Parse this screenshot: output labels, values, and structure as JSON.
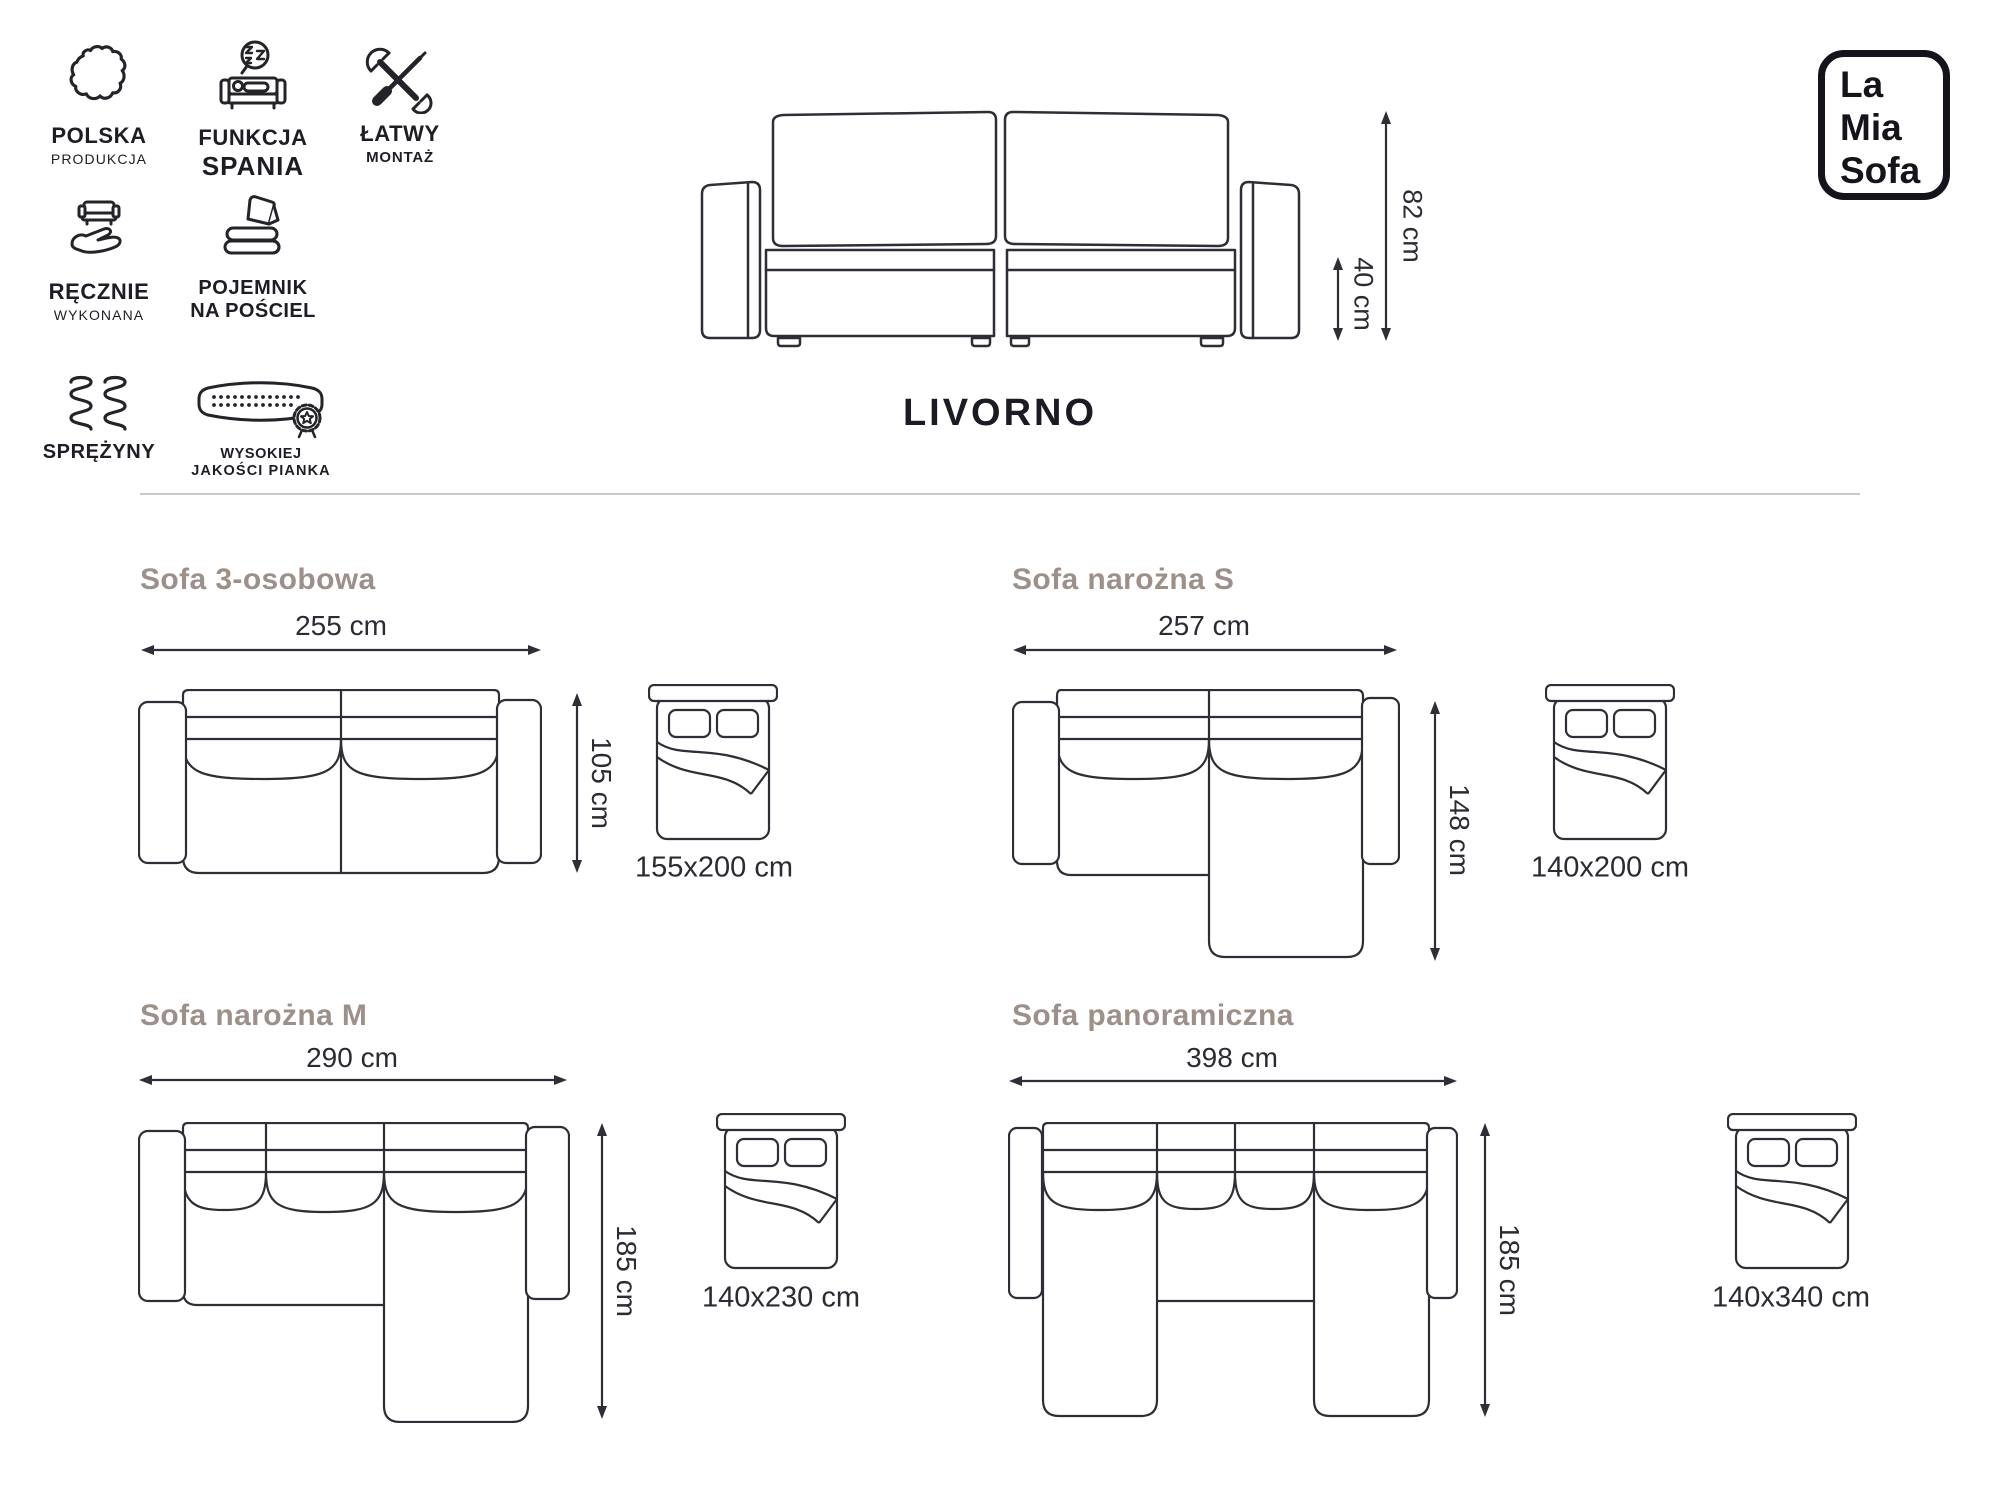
{
  "brand": {
    "lines": [
      "La",
      "Mia",
      "Sofa"
    ]
  },
  "product_name": "LIVORNO",
  "main": {
    "height_label": "82 cm",
    "seat_height_label": "40 cm"
  },
  "features": [
    {
      "id": "polska-produkcja",
      "icon": "poland-map-icon",
      "line1": "POLSKA",
      "line2": "PRODUKCJA"
    },
    {
      "id": "funkcja-spania",
      "icon": "sleep-function-icon",
      "line1": "FUNKCJA",
      "line2": "SPANIA"
    },
    {
      "id": "latwy-montaz",
      "icon": "tools-icon",
      "line1": "ŁATWY",
      "line2": "MONTAŻ"
    },
    {
      "id": "recznie-wykonana",
      "icon": "handmade-icon",
      "line1": "RĘCZNIE",
      "line2": "WYKONANA"
    },
    {
      "id": "pojemnik-na-posciel",
      "icon": "bedding-storage-icon",
      "line1": "POJEMNIK",
      "line2": "NA POŚCIEL"
    },
    {
      "id": "sprezyny",
      "icon": "springs-icon",
      "line1": "SPRĘŻYNY",
      "line2": ""
    },
    {
      "id": "wysokiej-jakosci-pianka",
      "icon": "foam-quality-icon",
      "line1": "WYSOKIEJ",
      "line2": "JAKOŚCI PIANKA"
    }
  ],
  "variants": [
    {
      "id": "sofa-3-osobowa",
      "title": "Sofa 3-osobowa",
      "width_label": "255 cm",
      "depth_label": "105 cm",
      "bed_label": "155x200 cm"
    },
    {
      "id": "sofa-narozna-s",
      "title": "Sofa narożna S",
      "width_label": "257 cm",
      "depth_label": "148 cm",
      "bed_label": "140x200 cm"
    },
    {
      "id": "sofa-narozna-m",
      "title": "Sofa narożna M",
      "width_label": "290 cm",
      "depth_label": "185 cm",
      "bed_label": "140x230 cm"
    },
    {
      "id": "sofa-panoramiczna",
      "title": "Sofa panoramiczna",
      "width_label": "398 cm",
      "depth_label": "185 cm",
      "bed_label": "140x340 cm"
    }
  ],
  "colors": {
    "line_art": "#2e2e36",
    "section_heading": "#9c9089",
    "text": "#2b2b33",
    "divider": "#c9c9c9",
    "logo": "#14141c"
  }
}
